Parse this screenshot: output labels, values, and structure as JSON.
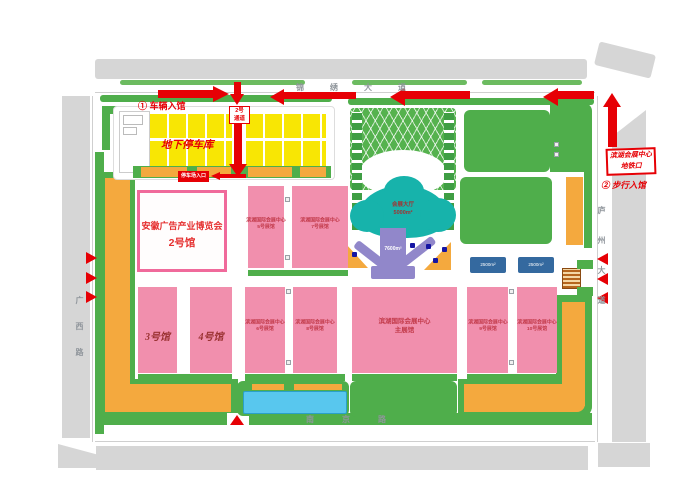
{
  "map": {
    "entrances": {
      "vehicle": "① 车辆入馆",
      "walk": "② 步行入馆",
      "gate_line1": "2号",
      "gate_line2": "通道",
      "metro_line1": "滨湖会展中心",
      "metro_line2": "地铁口",
      "parking_badge": "停车场入口"
    },
    "areas": {
      "underground_parking": "地下停车库",
      "expo_line1": "安徽广告产业博览会",
      "expo_line2": "2号馆",
      "atrium_line1": "会展大厅",
      "atrium_line2": "5000m²",
      "concourse": "7600m²",
      "blue_bar1": "2500m²",
      "blue_bar2": "2500m²"
    },
    "halls": {
      "center_name": "滨湖国际会展中心",
      "h3": "3号馆",
      "h4": "4号馆",
      "m1": "5号展馆",
      "m2": "7号展馆",
      "b1": "6号展馆",
      "b2": "8号展馆",
      "main": "主展馆",
      "b3": "9号展馆",
      "b4": "10号展馆"
    },
    "roads": {
      "north": "锦绣大道",
      "west": "广西路",
      "east": "庐州大道",
      "south": "南京路"
    },
    "colors": {
      "accent_red": "#e60005",
      "hall_pink": "#f18fad",
      "green": "#4fae4b",
      "parking_yellow": "#f8e604",
      "orange": "#f4a93e",
      "atrium_teal": "#17b3ab",
      "concourse_purple": "#9187ca",
      "road_gray": "#d6d6d6"
    }
  }
}
